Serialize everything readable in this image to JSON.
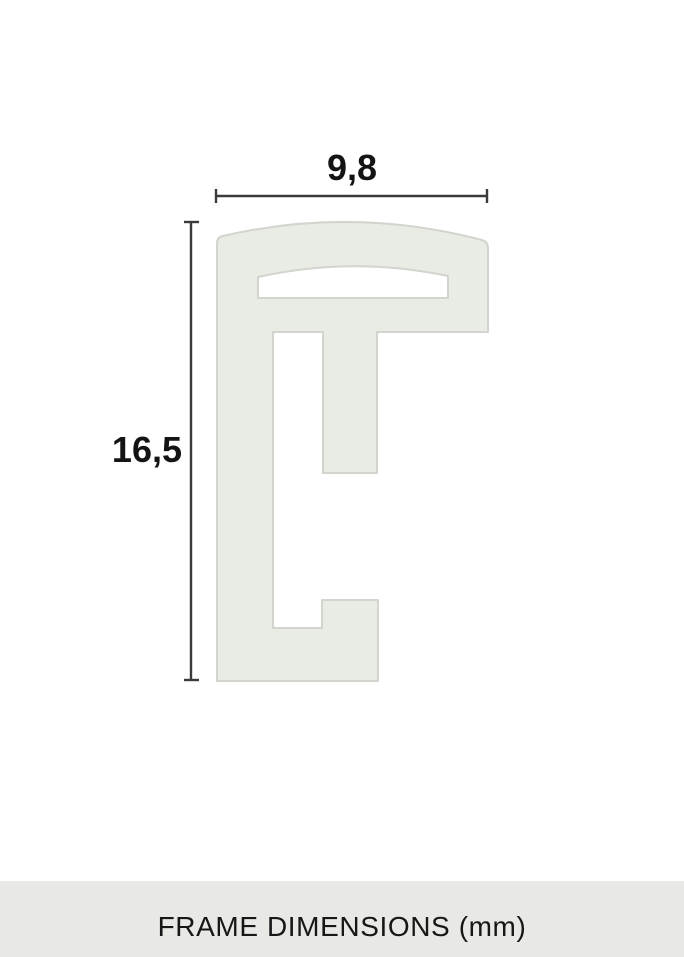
{
  "diagram": {
    "caption": "FRAME DIMENSIONS (mm)",
    "unit": "mm",
    "dimensions": {
      "width": "9,8",
      "height": "16,5"
    },
    "colors": {
      "background": "#ffffff",
      "profile_fill": "#e9ebe5",
      "profile_stroke": "#d2d4ce",
      "dimension_line": "#3b3b3d",
      "dimension_text": "#141414",
      "caption_bg": "#e8e8e4",
      "caption_text": "#171717"
    }
  }
}
